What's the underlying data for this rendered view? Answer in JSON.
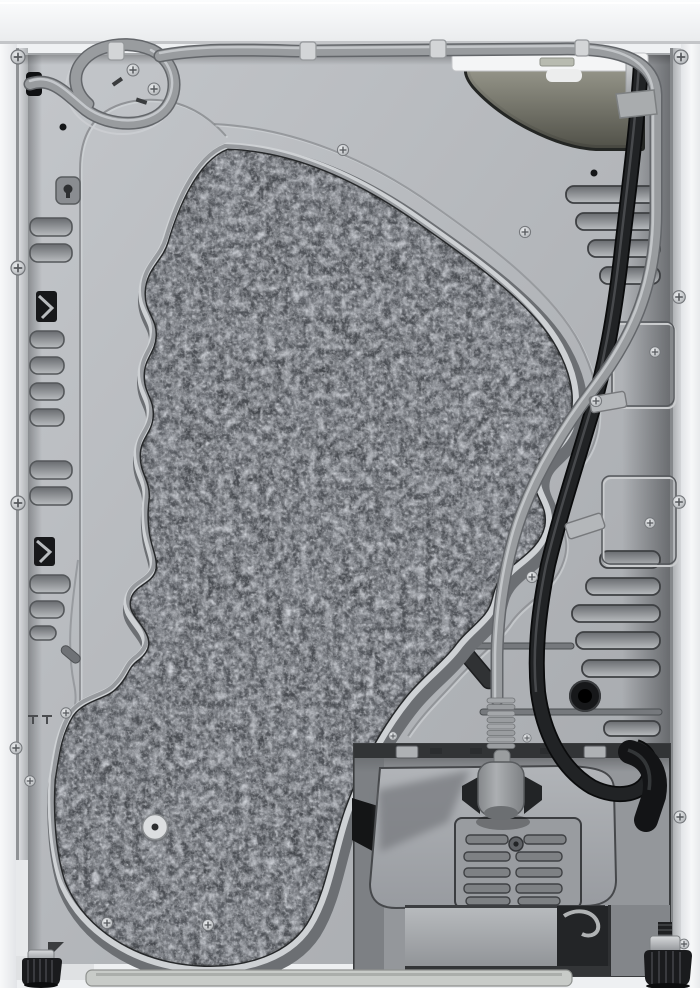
{
  "meta": {
    "description": "Product photo: rear view of a white tumble dryer showing the sheet-metal back panel, a large dark felt insulation pad, a gray power cord with service loop and hanging plug, a black drain hose, ventilation louvers, a bottom condenser compartment with grille and drawer, and adjustable feet."
  },
  "colors": {
    "cabinet_white": "#eef0f2",
    "trim_white": "#f4f5f6",
    "metal_panel": "#b6b9bd",
    "felt_pad": "#44474c",
    "hose_gray": "#999c9f",
    "cable_black": "#212325",
    "olive_panel": "#808074",
    "recess_gray": "#94979b",
    "base_strip": "#c8cbc8",
    "foot_black": "#1a1b1d",
    "drawer_gray": "#aaadb0"
  },
  "parts": {
    "back_panel": "galvanized steel rear panel",
    "insulation_pad": "dark gray felt sound-damping pad",
    "pad_rim": "stamped raised rim around felt pad",
    "service_loop": "gray cord service loop, top left",
    "power_cord": "gray mains cord routed across top and down the middle",
    "power_plug": "gray plug stored above condenser cover",
    "drain_hose": "black hose down the right side looping into compartment",
    "terminal_cover": "olive triangular terminal cover, top right",
    "left_vents": "louver column, left edge",
    "right_vents_upper": "louver group, upper right",
    "right_vents_lower": "louver group, lower right",
    "cable_grommet": "black rubber grommet, lower right",
    "cord_clips": "cord retaining clips along the top",
    "retainer_plates": "embossed cable retainer plates, right side",
    "condenser_grille": "molded grille on bottom compartment cover",
    "bottom_drawer": "plain drawer front, bottom center",
    "adjustable_feet": "black knurled leveling feet",
    "screws": "phillips screws around panel and frame",
    "center_plug": "round plastic plug at pad center bottom"
  }
}
